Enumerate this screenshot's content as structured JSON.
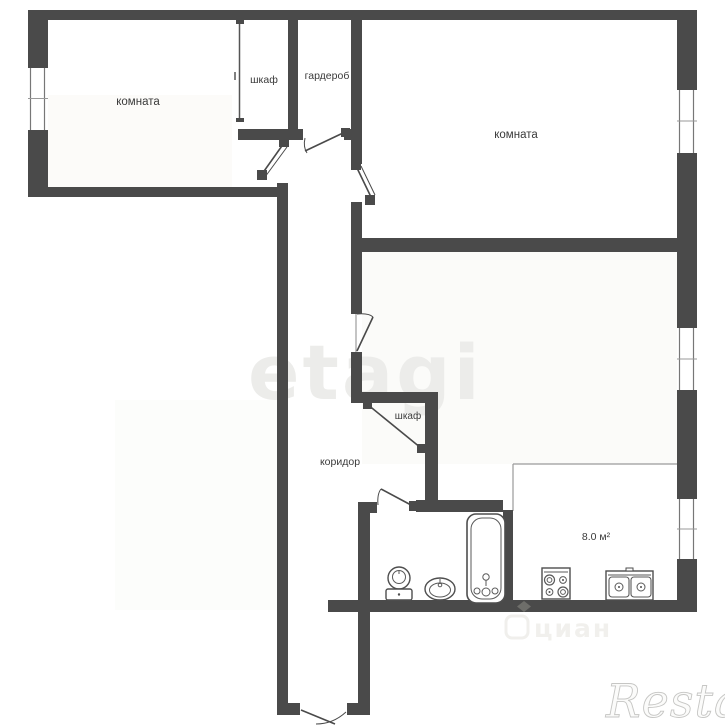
{
  "plan": {
    "type": "apartment-floor-plan",
    "rooms": {
      "room_top_left": {
        "label": "комната"
      },
      "closet_top": {
        "label": "шкаф"
      },
      "wardrobe": {
        "label": "гардероб"
      },
      "room_top_right": {
        "label": "комната"
      },
      "corridor": {
        "label": "коридор"
      },
      "closet_mid": {
        "label": "шкаф"
      },
      "kitchen": {
        "area_label": "8.0 м²"
      }
    },
    "fixtures": [
      "bathtub",
      "toilet",
      "washbasin",
      "stove",
      "kitchen-double-sink"
    ],
    "windows_count": 4,
    "doors_count": 7
  },
  "watermarks": {
    "center": "etagi",
    "bottom_center": "циан",
    "bottom_right": "Restate"
  },
  "colors": {
    "wall": "#4a4a4a",
    "background": "#ffffff",
    "fixture_stroke": "#4e4e4e",
    "label": "#3a3a3a",
    "watermark_light": "#ececea",
    "watermark_script_stroke": "#c6c6c4"
  }
}
